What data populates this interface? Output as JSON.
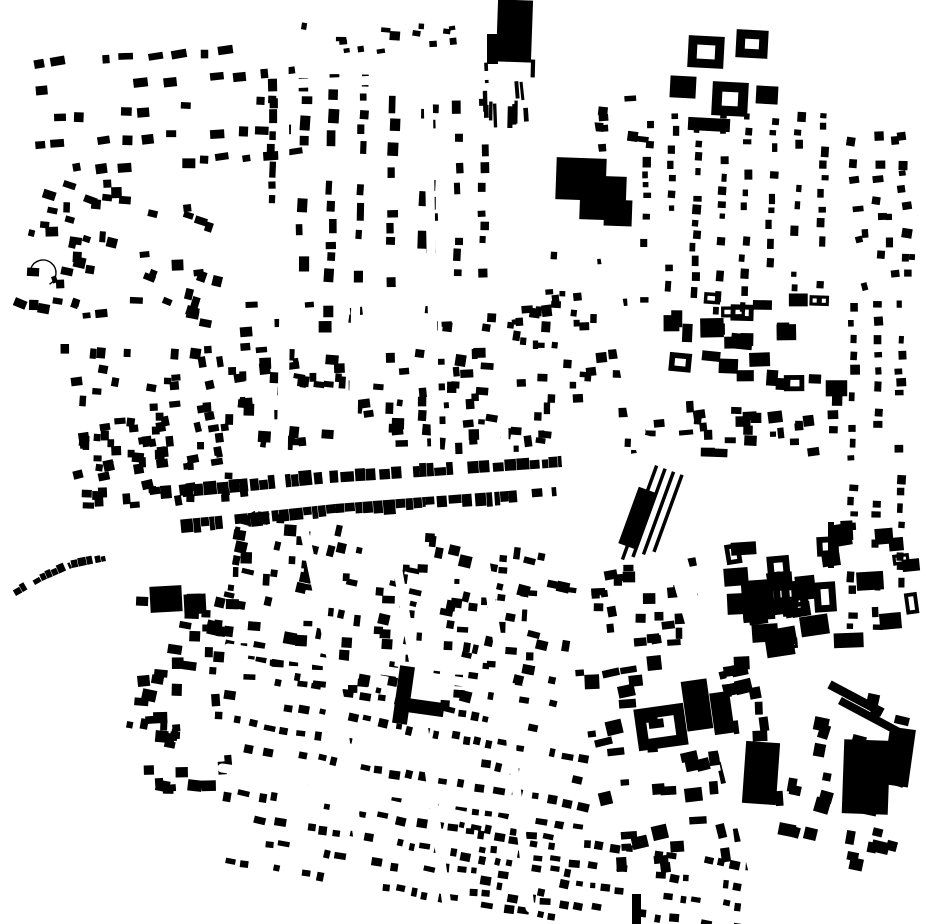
{
  "canvas": {
    "width": 930,
    "height": 924
  },
  "colors": {
    "background": "#ffffff",
    "building": "#000000",
    "street": "#ffffff"
  },
  "map": {
    "type": "figure-ground-building-footprint-map",
    "seed": 1337,
    "districts": [
      {
        "name": "nw-suburb-upper",
        "x": 30,
        "y": 48,
        "w": 265,
        "h": 125,
        "rot": -4,
        "pattern": "rows",
        "row_gap": 27,
        "bw": [
          7,
          16
        ],
        "bh": [
          6,
          10
        ],
        "gap": [
          4,
          16
        ],
        "skip": 0.38,
        "jitter": 14,
        "seed": 11
      },
      {
        "name": "nw-suburb-lower",
        "x": 22,
        "y": 175,
        "w": 205,
        "h": 150,
        "rot": 8,
        "pattern": "scatter",
        "count": 52,
        "bw": [
          6,
          13
        ],
        "bh": [
          5,
          11
        ],
        "jitter": 30,
        "seed": 12
      },
      {
        "name": "n-center-grid",
        "x": 265,
        "y": 72,
        "w": 160,
        "h": 210,
        "rot": 1,
        "pattern": "cols",
        "col_gap": 30,
        "bw": [
          6,
          11
        ],
        "bh": [
          7,
          18
        ],
        "gap": [
          3,
          12
        ],
        "skip": 0.34,
        "jitter": 6,
        "seed": 13
      },
      {
        "name": "n-mid-slivers",
        "x": 478,
        "y": 58,
        "w": 75,
        "h": 70,
        "rot": -2,
        "pattern": "scatter",
        "count": 12,
        "bw": [
          3,
          7
        ],
        "bh": [
          10,
          26
        ],
        "jitter": 8,
        "seed": 14
      },
      {
        "name": "n-top-sparse",
        "x": 300,
        "y": 18,
        "w": 170,
        "h": 48,
        "rot": 0,
        "pattern": "scatter",
        "count": 14,
        "bw": [
          5,
          11
        ],
        "bh": [
          4,
          9
        ],
        "jitter": 20,
        "seed": 15
      },
      {
        "name": "ne-top-gap-sparse",
        "x": 590,
        "y": 95,
        "w": 60,
        "h": 60,
        "rot": 0,
        "pattern": "scatter",
        "count": 8,
        "bw": [
          5,
          12
        ],
        "bh": [
          5,
          10
        ],
        "jitter": 15,
        "seed": 16
      },
      {
        "name": "ne-grid",
        "x": 640,
        "y": 108,
        "w": 205,
        "h": 205,
        "rot": 2,
        "pattern": "cols",
        "col_gap": 25,
        "bw": [
          5,
          9
        ],
        "bh": [
          5,
          11
        ],
        "gap": [
          3,
          10
        ],
        "skip": 0.34,
        "jitter": 6,
        "seed": 17
      },
      {
        "name": "ne-east-strip",
        "x": 848,
        "y": 130,
        "w": 70,
        "h": 160,
        "rot": -3,
        "pattern": "scatter",
        "count": 26,
        "bw": [
          5,
          11
        ],
        "bh": [
          5,
          10
        ],
        "jitter": 25,
        "seed": 18
      },
      {
        "name": "ne-courtyard-row",
        "x": 662,
        "y": 292,
        "w": 190,
        "h": 105,
        "rot": 2,
        "pattern": "scatter",
        "count": 26,
        "bw": [
          10,
          24
        ],
        "bh": [
          9,
          20
        ],
        "jitter": 8,
        "hollow": 0.35,
        "seed": 19
      },
      {
        "name": "e-mid-band",
        "x": 618,
        "y": 398,
        "w": 235,
        "h": 62,
        "rot": -2,
        "pattern": "scatter",
        "count": 34,
        "bw": [
          6,
          15
        ],
        "bh": [
          5,
          12
        ],
        "jitter": 12,
        "seed": 20
      },
      {
        "name": "far-right-strip",
        "x": 846,
        "y": 300,
        "w": 72,
        "h": 330,
        "rot": 0,
        "pattern": "cols",
        "col_gap": 24,
        "bw": [
          5,
          10
        ],
        "bh": [
          5,
          11
        ],
        "gap": [
          3,
          10
        ],
        "skip": 0.42,
        "jitter": 8,
        "seed": 21
      },
      {
        "name": "center-upper",
        "x": 228,
        "y": 298,
        "w": 325,
        "h": 155,
        "rot": 1,
        "pattern": "scatter",
        "count": 115,
        "bw": [
          5,
          13
        ],
        "bh": [
          5,
          12
        ],
        "jitter": 18,
        "seed": 22
      },
      {
        "name": "left-center",
        "x": 62,
        "y": 332,
        "w": 185,
        "h": 175,
        "rot": -2,
        "pattern": "scatter",
        "count": 55,
        "bw": [
          6,
          12
        ],
        "bh": [
          6,
          11
        ],
        "jitter": 25,
        "seed": 23
      },
      {
        "name": "mid-right-sparse",
        "x": 540,
        "y": 228,
        "w": 92,
        "h": 175,
        "rot": 0,
        "pattern": "scatter",
        "count": 26,
        "bw": [
          5,
          11
        ],
        "bh": [
          5,
          11
        ],
        "jitter": 15,
        "seed": 24
      },
      {
        "name": "center-south",
        "x": 218,
        "y": 528,
        "w": 355,
        "h": 175,
        "rot": 8,
        "pattern": "scatter",
        "count": 150,
        "bw": [
          5,
          13
        ],
        "bh": [
          5,
          12
        ],
        "jitter": 14,
        "seed": 25
      },
      {
        "name": "south-center-rows",
        "x": 238,
        "y": 700,
        "w": 345,
        "h": 195,
        "rot": 10,
        "pattern": "rows",
        "row_gap": 23,
        "bw": [
          5,
          12
        ],
        "bh": [
          5,
          9
        ],
        "gap": [
          3,
          12
        ],
        "skip": 0.34,
        "jitter": 8,
        "seed": 26
      },
      {
        "name": "south-left",
        "x": 128,
        "y": 588,
        "w": 115,
        "h": 235,
        "rot": 4,
        "pattern": "scatter",
        "count": 48,
        "bw": [
          6,
          15
        ],
        "bh": [
          6,
          13
        ],
        "jitter": 20,
        "seed": 27
      },
      {
        "name": "se-mixed",
        "x": 588,
        "y": 648,
        "w": 190,
        "h": 225,
        "rot": -8,
        "pattern": "scatter",
        "count": 55,
        "bw": [
          7,
          18
        ],
        "bh": [
          6,
          15
        ],
        "jitter": 12,
        "seed": 28
      },
      {
        "name": "e-blocks",
        "x": 722,
        "y": 518,
        "w": 205,
        "h": 135,
        "rot": -6,
        "pattern": "scatter",
        "count": 30,
        "bw": [
          12,
          30
        ],
        "bh": [
          10,
          24
        ],
        "jitter": 8,
        "hollow": 0.3,
        "seed": 29
      },
      {
        "name": "bottom-right",
        "x": 788,
        "y": 690,
        "w": 125,
        "h": 185,
        "rot": 14,
        "pattern": "scatter",
        "count": 30,
        "bw": [
          8,
          18
        ],
        "bh": [
          7,
          15
        ],
        "jitter": 10,
        "seed": 30
      },
      {
        "name": "bottom-edge-rows",
        "x": 438,
        "y": 838,
        "w": 310,
        "h": 84,
        "rot": 8,
        "pattern": "rows",
        "row_gap": 21,
        "bw": [
          5,
          11
        ],
        "bh": [
          5,
          9
        ],
        "gap": [
          3,
          10
        ],
        "skip": 0.3,
        "jitter": 10,
        "seed": 31
      },
      {
        "name": "west-of-ribbon",
        "x": 78,
        "y": 425,
        "w": 150,
        "h": 85,
        "rot": -5,
        "pattern": "scatter",
        "count": 35,
        "bw": [
          6,
          12
        ],
        "bh": [
          6,
          11
        ],
        "jitter": 20,
        "seed": 32
      },
      {
        "name": "n-col-440",
        "x": 425,
        "y": 95,
        "w": 75,
        "h": 190,
        "rot": 0,
        "pattern": "cols",
        "col_gap": 26,
        "bw": [
          6,
          10
        ],
        "bh": [
          6,
          14
        ],
        "gap": [
          3,
          10
        ],
        "skip": 0.4,
        "jitter": 6,
        "seed": 33
      },
      {
        "name": "mid-625-band",
        "x": 580,
        "y": 560,
        "w": 120,
        "h": 90,
        "rot": -5,
        "pattern": "scatter",
        "count": 25,
        "bw": [
          6,
          14
        ],
        "bh": [
          6,
          12
        ],
        "jitter": 12,
        "seed": 34
      }
    ],
    "streets": [
      {
        "name": "high-street",
        "points": [
          [
            58,
            602
          ],
          [
            160,
            558
          ],
          [
            252,
            506
          ],
          [
            360,
            486
          ],
          [
            470,
            477
          ],
          [
            575,
            468
          ],
          [
            640,
            458
          ]
        ],
        "width": 11
      },
      {
        "name": "ns-street-a",
        "points": [
          [
            283,
            58
          ],
          [
            285,
            300
          ],
          [
            282,
            468
          ]
        ],
        "width": 11
      },
      {
        "name": "ns-street-b",
        "points": [
          [
            356,
            292
          ],
          [
            352,
            470
          ]
        ],
        "width": 9
      },
      {
        "name": "ns-street-c",
        "points": [
          [
            428,
            84
          ],
          [
            432,
            300
          ],
          [
            436,
            462
          ]
        ],
        "width": 9
      },
      {
        "name": "ns-street-d",
        "points": [
          [
            503,
            330
          ],
          [
            505,
            468
          ]
        ],
        "width": 8
      },
      {
        "name": "north-diagonal-road",
        "points": [
          [
            577,
            58
          ],
          [
            605,
            240
          ],
          [
            638,
            432
          ]
        ],
        "width": 15
      },
      {
        "name": "south-diagonal-road",
        "points": [
          [
            645,
            445
          ],
          [
            700,
            640
          ],
          [
            768,
            908
          ]
        ],
        "width": 20
      },
      {
        "name": "east-road",
        "points": [
          [
            648,
            460
          ],
          [
            930,
            470
          ]
        ],
        "width": 11
      },
      {
        "name": "south-street-1",
        "points": [
          [
            302,
            520
          ],
          [
            340,
            700
          ],
          [
            368,
            918
          ]
        ],
        "width": 9
      },
      {
        "name": "south-street-2",
        "points": [
          [
            388,
            512
          ],
          [
            420,
            700
          ],
          [
            448,
            914
          ]
        ],
        "width": 9
      },
      {
        "name": "south-street-3",
        "points": [
          [
            476,
            502
          ],
          [
            505,
            690
          ],
          [
            530,
            908
          ]
        ],
        "width": 9
      },
      {
        "name": "south-cross-1",
        "points": [
          [
            228,
            648
          ],
          [
            588,
            700
          ]
        ],
        "width": 9
      },
      {
        "name": "south-cross-2",
        "points": [
          [
            222,
            768
          ],
          [
            596,
            822
          ]
        ],
        "width": 9
      },
      {
        "name": "north-cross",
        "points": [
          [
            286,
            84
          ],
          [
            520,
            74
          ]
        ],
        "width": 9
      }
    ],
    "terraces": [
      {
        "name": "high-street-north-terrace",
        "points": [
          [
            150,
            500
          ],
          [
            240,
            492
          ],
          [
            330,
            483
          ],
          [
            420,
            477
          ],
          [
            505,
            471
          ],
          [
            562,
            467
          ]
        ],
        "depth": 13,
        "side": -1,
        "seg": [
          5,
          14
        ],
        "gap_chance": 0.1,
        "seed": 41
      },
      {
        "name": "high-street-south-terrace",
        "points": [
          [
            165,
            521
          ],
          [
            250,
            513
          ],
          [
            335,
            504
          ],
          [
            425,
            497
          ],
          [
            508,
            491
          ],
          [
            556,
            487
          ]
        ],
        "depth": 13,
        "side": 1,
        "seg": [
          5,
          14
        ],
        "gap_chance": 0.12,
        "seed": 42
      },
      {
        "name": "left-curved-terrace",
        "points": [
          [
            16,
            596
          ],
          [
            42,
            581
          ],
          [
            72,
            568
          ],
          [
            106,
            561
          ]
        ],
        "depth": 8,
        "side": -1,
        "seg": [
          4,
          9
        ],
        "gap_chance": 0.15,
        "seed": 43
      }
    ],
    "landmarks": [
      {
        "type": "rect",
        "name": "top-tower-block",
        "x": 497,
        "y": 0,
        "w": 35,
        "h": 62,
        "rot": 2
      },
      {
        "type": "rect",
        "name": "top-tower-annex",
        "x": 487,
        "y": 34,
        "w": 11,
        "h": 30,
        "rot": 0
      },
      {
        "type": "rect",
        "name": "ne-large-complex-a",
        "x": 556,
        "y": 158,
        "w": 50,
        "h": 42,
        "rot": 2
      },
      {
        "type": "rect",
        "name": "ne-large-complex-b",
        "x": 580,
        "y": 176,
        "w": 46,
        "h": 44,
        "rot": 2
      },
      {
        "type": "rect",
        "name": "ne-large-complex-c",
        "x": 604,
        "y": 200,
        "w": 28,
        "h": 26,
        "rot": 2
      },
      {
        "type": "ring",
        "name": "ne-courtyard-1",
        "x": 688,
        "y": 36,
        "w": 36,
        "h": 32,
        "inset": 9,
        "rot": 3
      },
      {
        "type": "ring",
        "name": "ne-courtyard-2",
        "x": 736,
        "y": 30,
        "w": 32,
        "h": 28,
        "inset": 9,
        "rot": 3
      },
      {
        "type": "rect",
        "name": "ne-block-3",
        "x": 670,
        "y": 76,
        "w": 26,
        "h": 22,
        "rot": 3
      },
      {
        "type": "ring",
        "name": "ne-courtyard-4",
        "x": 712,
        "y": 82,
        "w": 36,
        "h": 34,
        "inset": 10,
        "rot": 3
      },
      {
        "type": "rect",
        "name": "ne-block-5",
        "x": 756,
        "y": 86,
        "w": 22,
        "h": 18,
        "rot": 3
      },
      {
        "type": "rect",
        "name": "ne-bar-6",
        "x": 688,
        "y": 118,
        "w": 42,
        "h": 13,
        "rot": 3
      },
      {
        "type": "strips",
        "name": "station-platforms",
        "x": 655,
        "y": 465,
        "len": 100,
        "n": 4,
        "gap": 9,
        "thickness": 3.5,
        "rot": 20
      },
      {
        "type": "rect",
        "name": "station-hall",
        "x": 628,
        "y": 488,
        "w": 18,
        "h": 60,
        "rot": 20
      },
      {
        "type": "rect",
        "name": "e-block-a",
        "x": 742,
        "y": 580,
        "w": 32,
        "h": 40,
        "rot": -4
      },
      {
        "type": "ring",
        "name": "e-courtyard-b",
        "x": 782,
        "y": 582,
        "w": 26,
        "h": 34,
        "inset": 8,
        "rot": -4
      },
      {
        "type": "ring",
        "name": "e-courtyard-c",
        "x": 814,
        "y": 582,
        "w": 22,
        "h": 30,
        "inset": 7,
        "rot": -4
      },
      {
        "type": "rect",
        "name": "e-block-d",
        "x": 752,
        "y": 624,
        "w": 26,
        "h": 18,
        "rot": -4
      },
      {
        "type": "ring",
        "name": "se-courtyard-block",
        "x": 636,
        "y": 706,
        "w": 50,
        "h": 42,
        "inset": 11,
        "rot": -8
      },
      {
        "type": "rect",
        "name": "se-slab-a",
        "x": 684,
        "y": 680,
        "w": 26,
        "h": 50,
        "rot": -8
      },
      {
        "type": "rect",
        "name": "se-slab-b",
        "x": 712,
        "y": 692,
        "w": 20,
        "h": 42,
        "rot": -8
      },
      {
        "type": "rect",
        "name": "se-slab-c",
        "x": 744,
        "y": 742,
        "w": 34,
        "h": 62,
        "rot": 4
      },
      {
        "type": "rect",
        "name": "se-industrial-a",
        "x": 843,
        "y": 740,
        "w": 46,
        "h": 74,
        "rot": 2
      },
      {
        "type": "rect",
        "name": "se-industrial-b",
        "x": 886,
        "y": 728,
        "w": 26,
        "h": 58,
        "rot": 8
      },
      {
        "type": "rect",
        "name": "se-shed-bar-1",
        "x": 826,
        "y": 694,
        "w": 60,
        "h": 9,
        "rot": 28
      },
      {
        "type": "rect",
        "name": "se-shed-bar-2",
        "x": 836,
        "y": 712,
        "w": 66,
        "h": 8,
        "rot": 28
      },
      {
        "type": "rect",
        "name": "south-l-building-stem",
        "x": 396,
        "y": 666,
        "w": 15,
        "h": 58,
        "rot": 8
      },
      {
        "type": "rect",
        "name": "south-l-building-arm",
        "x": 398,
        "y": 700,
        "w": 46,
        "h": 14,
        "rot": 8
      },
      {
        "type": "rect",
        "name": "west-chunk-a",
        "x": 150,
        "y": 586,
        "w": 32,
        "h": 26,
        "rot": -3
      },
      {
        "type": "rect",
        "name": "west-chunk-b",
        "x": 184,
        "y": 594,
        "w": 22,
        "h": 20,
        "rot": -3
      },
      {
        "type": "rect",
        "name": "bottom-bar",
        "x": 632,
        "y": 894,
        "w": 9,
        "h": 30,
        "rot": 0
      },
      {
        "type": "rect",
        "name": "right-thin-bar",
        "x": 828,
        "y": 522,
        "w": 6,
        "h": 46,
        "rot": 0
      },
      {
        "type": "arc",
        "name": "nw-crescent-road",
        "cx": 43,
        "cy": 273,
        "r": 13,
        "start": 200,
        "end": 420,
        "width": 1.4
      },
      {
        "type": "rect",
        "name": "nw-crescent-house",
        "x": 52,
        "y": 276,
        "w": 5,
        "h": 7,
        "rot": -20
      }
    ]
  }
}
